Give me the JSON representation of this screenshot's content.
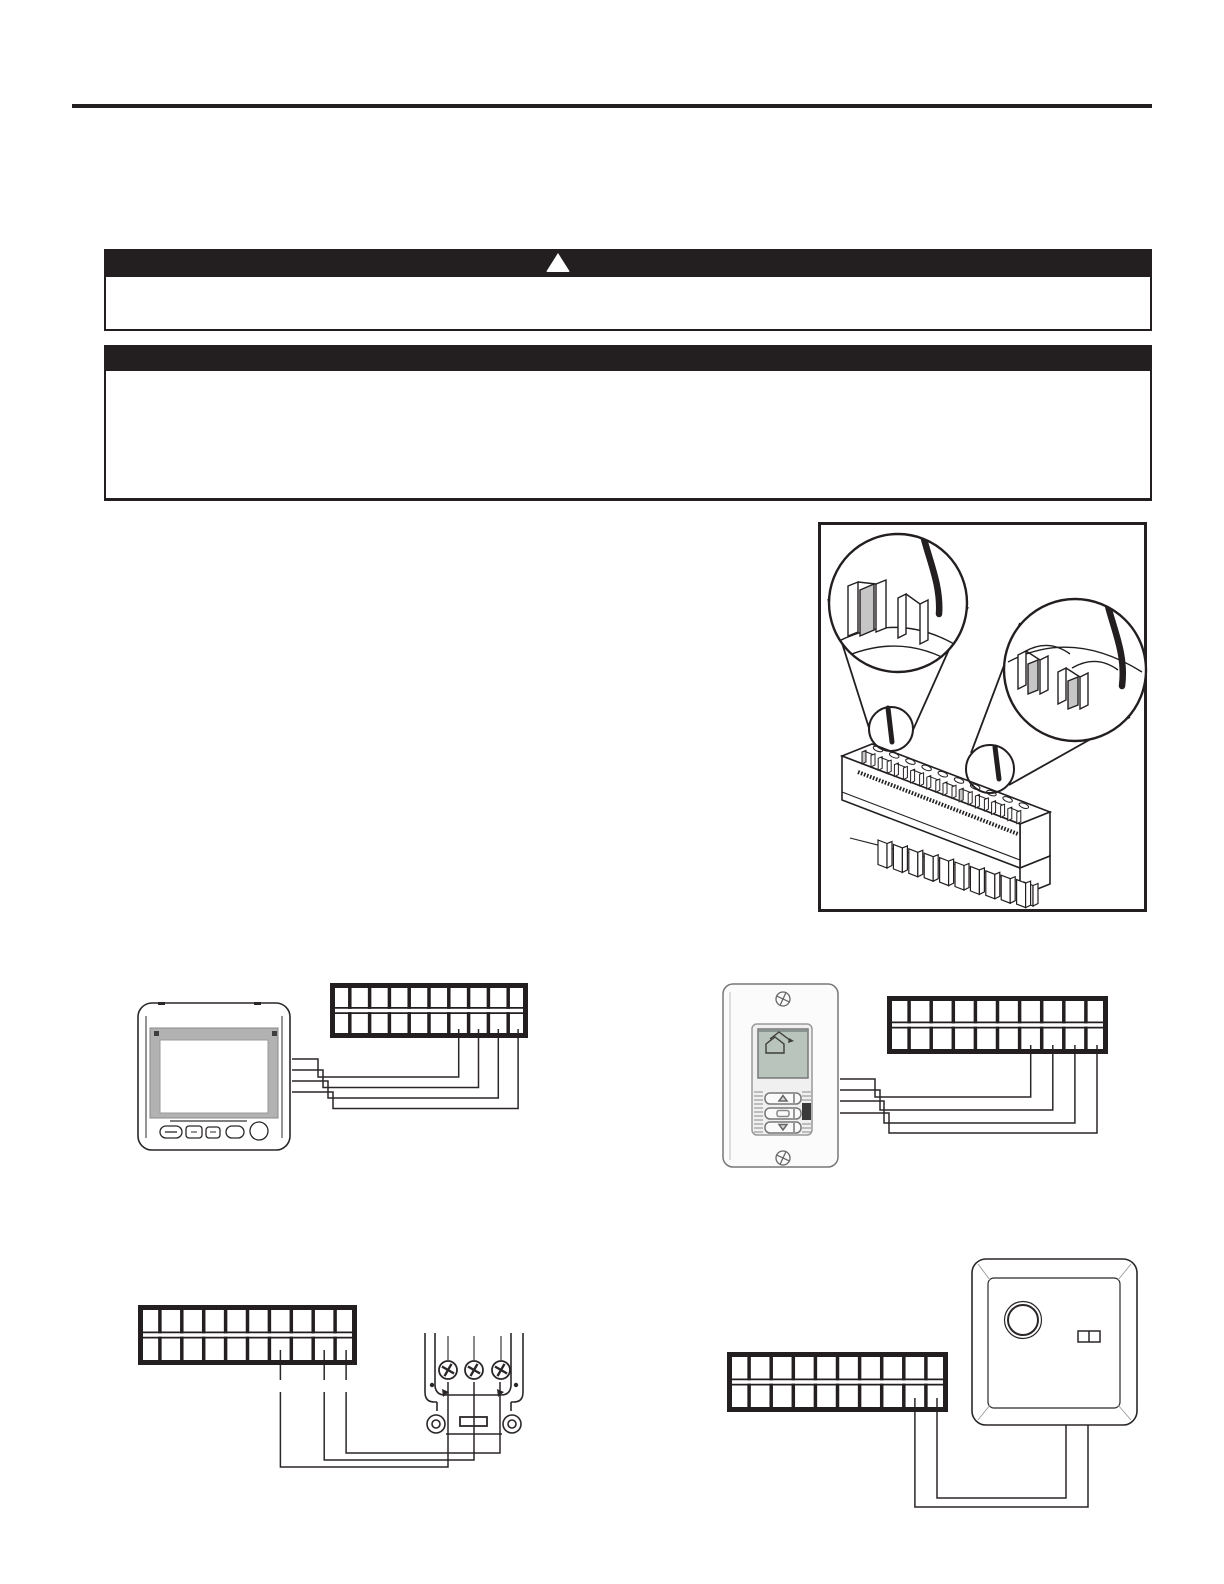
{
  "page": {
    "kind": "scanned-manual-page",
    "background": "#ffffff",
    "ink": "#231f20",
    "visible_text": ""
  },
  "header_rule": {
    "color": "#231f20"
  },
  "banners": [
    {
      "name": "warning-banner",
      "style": "solid-black-bar",
      "icon": "warning-triangle-icon",
      "icon_color": "#ffffff",
      "text": ""
    },
    {
      "name": "notice-banner",
      "style": "solid-black-bar",
      "icon": "",
      "text": ""
    }
  ],
  "figures": [
    {
      "name": "terminal-block-detail",
      "description": "isometric spring-clamp terminal block with two circular magnifier callouts showing wire insertion",
      "callouts": 2,
      "pins": 10,
      "metal_color": "#c6c6c6"
    },
    {
      "name": "touchscreen-thermostat-wiring",
      "device": "touchscreen-thermostat",
      "terminal_strip": {
        "rows": 2,
        "cols": 10
      },
      "wired_bottom_row_columns": [
        7,
        8,
        9,
        10
      ],
      "wires": 4,
      "screen_bezel_color": "#b2b2b2"
    },
    {
      "name": "wall-thermostat-wiring",
      "device": "wall-plate-thermostat",
      "terminal_strip": {
        "rows": 2,
        "cols": 10
      },
      "wired_bottom_row_columns": [
        7,
        8,
        9,
        10
      ],
      "wires": 4,
      "buttons": [
        "up",
        "ok",
        "down"
      ],
      "lcd_color": "#b9c4bd",
      "lcd_icon": "house-icon"
    },
    {
      "name": "actuator-terminal-wiring",
      "device": "screw-terminal-actuator",
      "terminal_strip": {
        "rows": 2,
        "cols": 10
      },
      "wired_bottom_row_columns": [
        7,
        9,
        10
      ],
      "wires": 3,
      "screw_terminals": 3
    },
    {
      "name": "knob-device-wiring",
      "device": "square-knob-controller",
      "terminal_strip": {
        "rows": 2,
        "cols": 10
      },
      "wired_bottom_row_columns": [
        9,
        10
      ],
      "wires": 2
    }
  ],
  "strip_cols": 10
}
